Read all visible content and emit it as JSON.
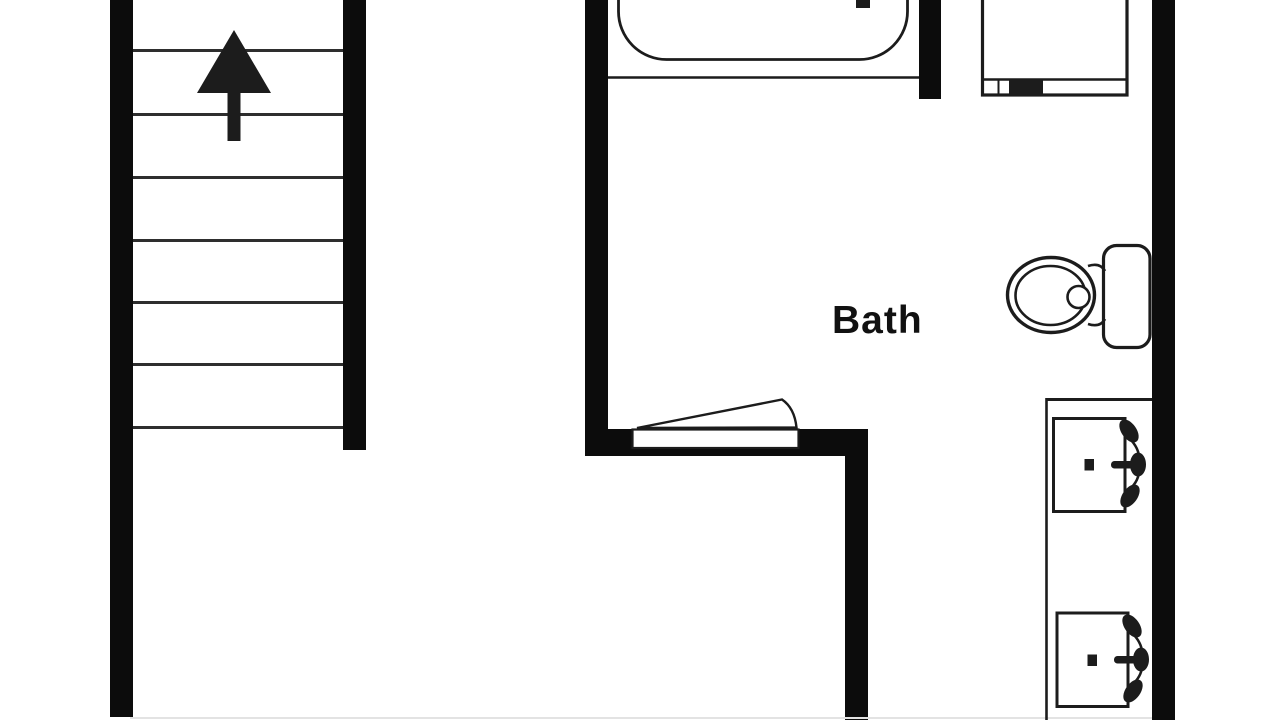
{
  "page": {
    "kind": "floor-plan",
    "width_px": 1280,
    "height_px": 720
  },
  "labels": {
    "room": "Bath"
  },
  "icons": {
    "stairs_direction_icon": "up-arrow"
  },
  "colors": {
    "wall": "#0c0c0c",
    "line": "#1c1c1c",
    "step_line": "#2e2e2e",
    "bg": "#ffffff",
    "faint": "#e3e3e3"
  },
  "fixtures": [
    "staircase-up",
    "bathtub",
    "appliance",
    "toilet",
    "bath-door",
    "vanity-counter",
    "sink-1",
    "sink-2"
  ],
  "walls": [
    {
      "name": "stair-left-wall",
      "x": 110,
      "y": 0,
      "w": 23,
      "h": 717
    },
    {
      "name": "stair-right-wall",
      "x": 343,
      "y": 0,
      "w": 23,
      "h": 450
    },
    {
      "name": "bath-left-wall",
      "x": 585,
      "y": 0,
      "w": 23,
      "h": 456
    },
    {
      "name": "tub-right-wall-stub",
      "x": 919,
      "y": 0,
      "w": 22,
      "h": 99
    },
    {
      "name": "right-outer-wall",
      "x": 1152,
      "y": 0,
      "w": 23,
      "h": 720
    },
    {
      "name": "bath-door-wall-band",
      "x": 585,
      "y": 429,
      "w": 283,
      "h": 27
    },
    {
      "name": "bath-lower-wall",
      "x": 845,
      "y": 450,
      "w": 23,
      "h": 270
    },
    {
      "name": "bottom-faint-wall-line",
      "x": 130,
      "y": 717,
      "w": 1022,
      "h": 2,
      "faint": true
    }
  ],
  "stairs": {
    "x": 133,
    "w": 210,
    "line_h": 3,
    "step_ys": [
      49,
      113,
      176,
      239,
      301,
      363,
      426
    ]
  }
}
